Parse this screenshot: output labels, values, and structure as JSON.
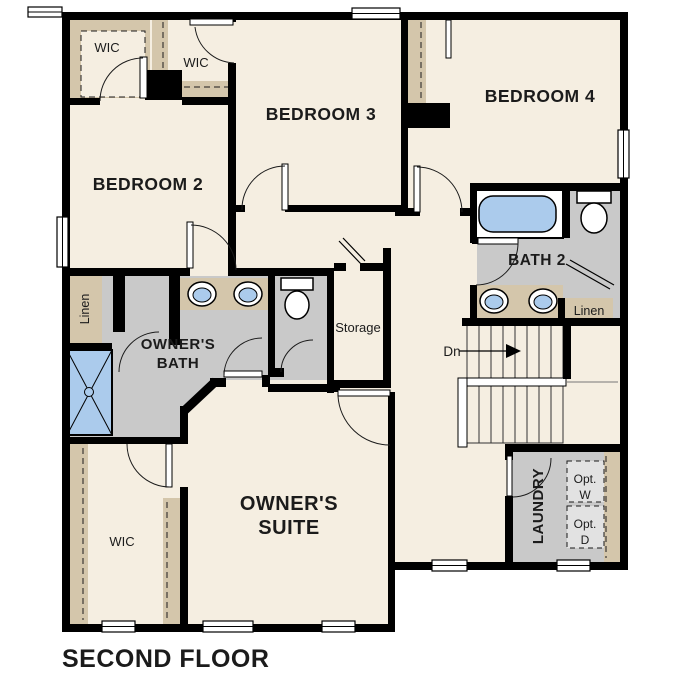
{
  "plan": {
    "title": "SECOND FLOOR",
    "colors": {
      "floor": "#f5eee1",
      "wet_area": "#c9c9c9",
      "closet_millwork": "#d4c6ab",
      "fixture_blue": "#abcbec",
      "appliance_box": "#e2e2e2",
      "wall": "#000000"
    },
    "rooms": {
      "bedroom2": {
        "label": "BEDROOM 2"
      },
      "bedroom3": {
        "label": "BEDROOM 3"
      },
      "bedroom4": {
        "label": "BEDROOM 4"
      },
      "bath2": {
        "label": "BATH 2"
      },
      "owners_bath": {
        "line1": "OWNER'S",
        "line2": "BATH"
      },
      "owners_suite": {
        "line1": "OWNER'S",
        "line2": "SUITE"
      },
      "laundry": {
        "label": "LAUNDRY"
      },
      "storage": {
        "label": "Storage"
      },
      "wic_bedroom2": {
        "label": "WIC"
      },
      "wic_bedroom3": {
        "label": "WIC"
      },
      "wic_owners": {
        "label": "WIC"
      },
      "linen_owners": {
        "label": "Linen"
      },
      "linen_bath2": {
        "label": "Linen"
      }
    },
    "annotations": {
      "stairs_direction": "Dn",
      "optional_washer_line1": "Opt.",
      "optional_washer_line2": "W",
      "optional_dryer_line1": "Opt.",
      "optional_dryer_line2": "D"
    }
  }
}
